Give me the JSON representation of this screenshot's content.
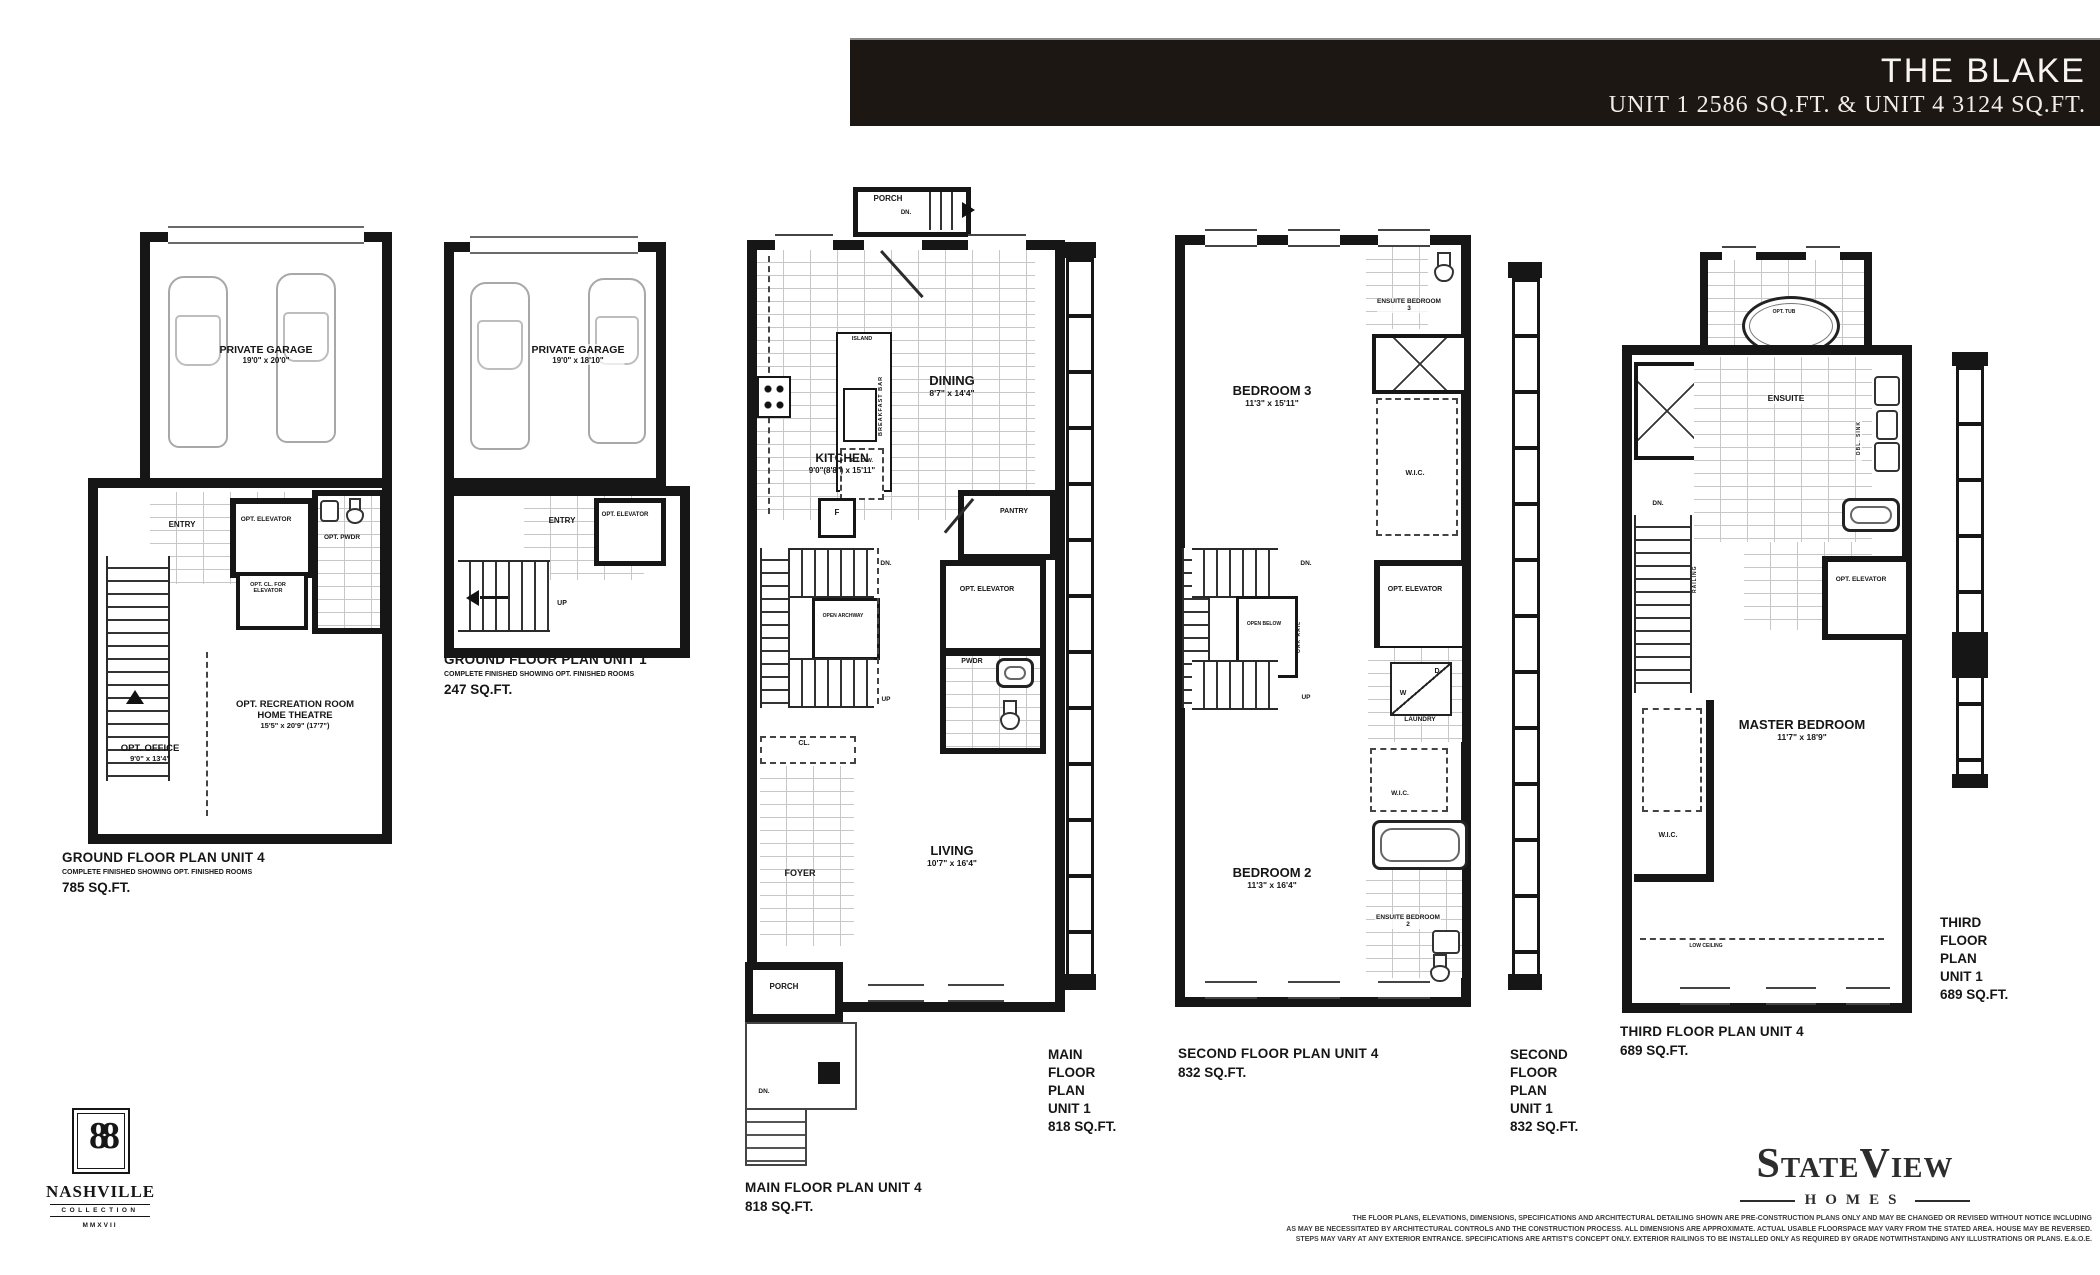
{
  "header": {
    "title": "THE BLAKE",
    "subtitle": "UNIT 1 2586 SQ.FT. & UNIT 4 3124 SQ.FT."
  },
  "colors": {
    "wall": "#161616",
    "band": "#1d1713"
  },
  "plans": {
    "ground4": {
      "caption": {
        "title": "GROUND FLOOR PLAN UNIT 4",
        "note": "COMPLETE FINISHED SHOWING OPT. FINISHED ROOMS",
        "area": "785 SQ.FT."
      },
      "garage": {
        "name": "PRIVATE GARAGE",
        "dims": "19'0\" x 20'0\""
      },
      "entry": "ENTRY",
      "opt_elevator": "OPT. ELEVATOR",
      "opt_cl_for_elevator": "OPT. CL. FOR ELEVATOR",
      "opt_pwdr": "OPT. PWDR",
      "office": {
        "name": "OPT. OFFICE",
        "dims": "9'0\" x 13'4\""
      },
      "recreation": {
        "name": "OPT. RECREATION ROOM HOME THEATRE",
        "dims": "15'5\" x 20'9\" (17'7\")"
      }
    },
    "ground1": {
      "caption": {
        "title": "GROUND FLOOR PLAN UNIT 1",
        "note": "COMPLETE FINISHED SHOWING OPT. FINISHED ROOMS",
        "area": "247 SQ.FT."
      },
      "garage": {
        "name": "PRIVATE GARAGE",
        "dims": "19'0\" x 18'10\""
      },
      "entry": "ENTRY",
      "opt_elevator": "OPT. ELEVATOR",
      "up": "UP"
    },
    "main": {
      "caption_unit4": {
        "title": "MAIN FLOOR PLAN UNIT 4",
        "area": "818 SQ.FT."
      },
      "caption_unit1": {
        "lines": [
          "MAIN",
          "FLOOR",
          "PLAN",
          "UNIT 1",
          "818 SQ.FT."
        ]
      },
      "porch_top": "PORCH",
      "dn_top": "DN.",
      "dining": {
        "name": "DINING",
        "dims": "8'7\" x 14'4\""
      },
      "island": "ISLAND",
      "breakfast_bar": "BREAKFAST BAR",
      "ri_dw": "R.I. D.W.",
      "kitchen": {
        "name": "KITCHEN",
        "dims": "9'0\"(8'8\") x 15'11\""
      },
      "fridge": "F",
      "pantry": "PANTRY",
      "dn": "DN.",
      "open_archway": "OPEN ARCHWAY",
      "up": "UP",
      "opt_elevator": "OPT. ELEVATOR",
      "pwdr": "PWDR",
      "cl": "CL.",
      "foyer": "FOYER",
      "living": {
        "name": "LIVING",
        "dims": "10'7\" x 16'4\""
      },
      "porch_bottom": "PORCH",
      "dn_bottom": "DN."
    },
    "second": {
      "caption_unit4": {
        "title": "SECOND FLOOR PLAN UNIT 4",
        "area": "832 SQ.FT."
      },
      "caption_unit1": {
        "lines": [
          "SECOND",
          "FLOOR",
          "PLAN",
          "UNIT 1",
          "832 SQ.FT."
        ]
      },
      "ensuite3": "ENSUITE BEDROOM 3",
      "bedroom3": {
        "name": "BEDROOM 3",
        "dims": "11'3\" x 15'11\""
      },
      "wic1": "W.I.C.",
      "dn": "DN.",
      "open_below": "OPEN BELOW",
      "oak_rail": "OAK RAIL",
      "up": "UP",
      "opt_elevator": "OPT. ELEVATOR",
      "dryer": "D",
      "washer": "W",
      "laundry": "LAUNDRY",
      "wic2": "W.I.C.",
      "bedroom2": {
        "name": "BEDROOM 2",
        "dims": "11'3\" x 16'4\""
      },
      "ensuite2": "ENSUITE BEDROOM 2"
    },
    "third": {
      "caption_unit4": {
        "title": "THIRD FLOOR PLAN UNIT 4",
        "area": "689 SQ.FT."
      },
      "caption_unit1": {
        "lines": [
          "THIRD",
          "FLOOR",
          "PLAN",
          "UNIT 1",
          "689 SQ.FT."
        ]
      },
      "opt_tub": "OPT. TUB",
      "low_ceiling_top": "LOW CEILING",
      "ensuite": "ENSUITE",
      "dbl_sink": "DBL. SINK",
      "dn": "DN.",
      "railing": "RAILING",
      "opt_elevator": "OPT. ELEVATOR",
      "wic": "W.I.C.",
      "master": {
        "name": "MASTER BEDROOM",
        "dims": "11'7\" x 18'9\""
      },
      "low_ceiling_bottom": "LOW CEILING"
    }
  },
  "footer": {
    "nashville": {
      "monogram": "88",
      "name": "NASHVILLE",
      "collection": "COLLECTION",
      "year": "MMXVII"
    },
    "stateview": {
      "name": "StateView",
      "homes": "HOMES"
    },
    "disclaimer": {
      "line1": "THE FLOOR PLANS, ELEVATIONS, DIMENSIONS, SPECIFICATIONS AND ARCHITECTURAL DETAILING SHOWN ARE PRE-CONSTRUCTION PLANS ONLY AND MAY BE CHANGED OR REVISED WITHOUT NOTICE INCLUDING",
      "line2": "AS MAY BE NECESSITATED BY ARCHITECTURAL CONTROLS AND THE CONSTRUCTION PROCESS. ALL DIMENSIONS ARE APPROXIMATE. ACTUAL USABLE FLOORSPACE MAY VARY FROM THE STATED AREA. HOUSE MAY BE REVERSED.",
      "line3": "STEPS MAY VARY AT ANY EXTERIOR ENTRANCE. SPECIFICATIONS ARE ARTIST'S CONCEPT ONLY. EXTERIOR RAILINGS TO BE INSTALLED ONLY AS REQUIRED BY GRADE NOTWITHSTANDING ANY ILLUSTRATIONS OR PLANS. E.&.O.E."
    }
  }
}
